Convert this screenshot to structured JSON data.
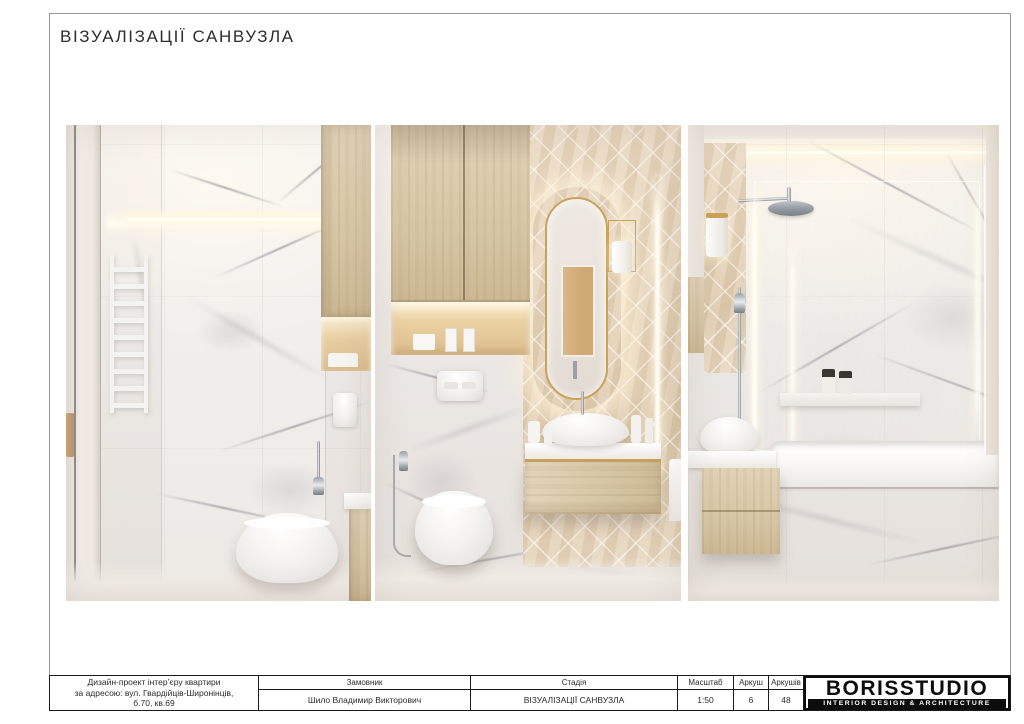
{
  "page": {
    "title": "ВІЗУАЛІЗАЦІЇ САНВУЗЛА"
  },
  "titleblock": {
    "project": {
      "line1": "Дизайн-проект інтер’єру квартири",
      "line2": "за адресою: вул. Гвардійців-Широнінців,",
      "line3": "б.70, кв.69"
    },
    "customer": {
      "header": "Замовник",
      "value": "Шило Владимир Викторович"
    },
    "stage": {
      "header": "Стадія",
      "value": "ВІЗУАЛІЗАЦІЇ САНВУЗЛА"
    },
    "scale": {
      "header": "Масштаб",
      "value": "1:50"
    },
    "sheet": {
      "header": "Аркуш",
      "value": "6"
    },
    "sheets": {
      "header": "Аркушів",
      "value": "48"
    },
    "logo": {
      "name": "BORISSTUDIO",
      "tagline": "INTERIOR DESIGN & ARCHITECTURE"
    }
  },
  "colors": {
    "accent_gold": "#c9a25c",
    "wood": "#d8c6a6",
    "marble_base": "#efecea",
    "marble_vein": "#9a939a",
    "herringbone_tile": "#e6d4ba",
    "glow_warm": "#fff3d8",
    "logo_black": "#0d0d0d",
    "frame_gray": "#9a9a9a"
  }
}
